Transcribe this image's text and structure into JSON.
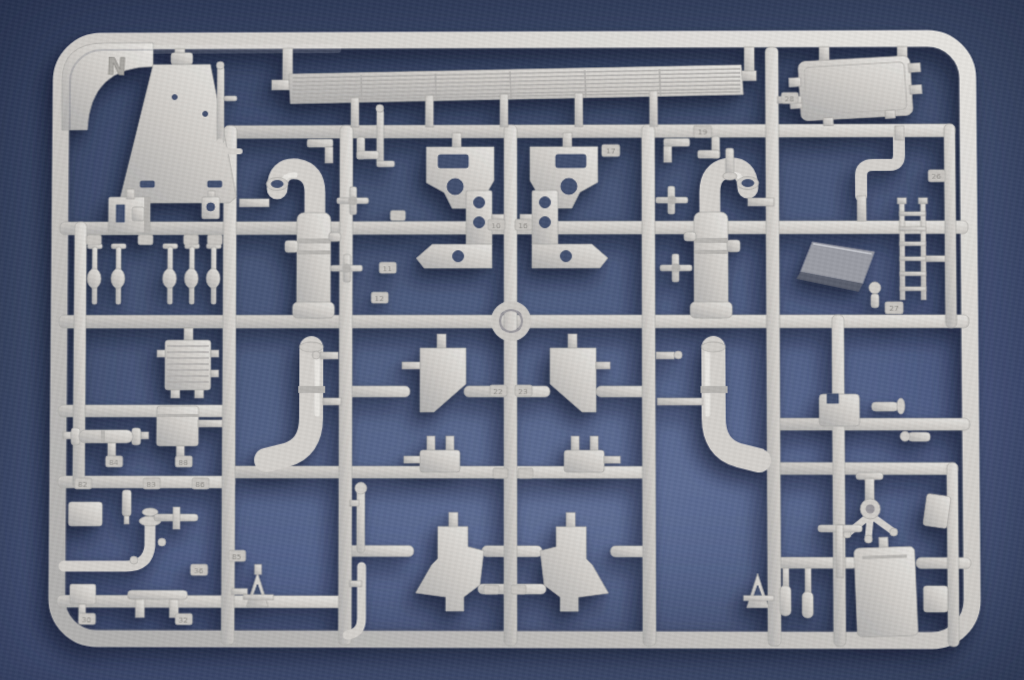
{
  "scene": {
    "subject": "Light grey injection-molded plastic model kit sprue (runner N) with unassembled parts, photographed on a blue backdrop",
    "sprue_letter": "N"
  },
  "colors": {
    "backdrop": "#4d5b7d",
    "backdrop_dark": "#3b496b",
    "backdrop_light": "#51608a",
    "plastic": "#cfccc8",
    "plastic_highlight": "#e6e4e0",
    "plastic_shade": "#a8a6a3",
    "cast_shadow": "rgba(14,20,40,0.5)"
  },
  "tags": [
    "19",
    "17",
    "10",
    "16",
    "11",
    "12",
    "28",
    "26",
    "27",
    "22",
    "23",
    "84",
    "88",
    "82",
    "83",
    "86",
    "85",
    "36",
    "30",
    "32"
  ]
}
